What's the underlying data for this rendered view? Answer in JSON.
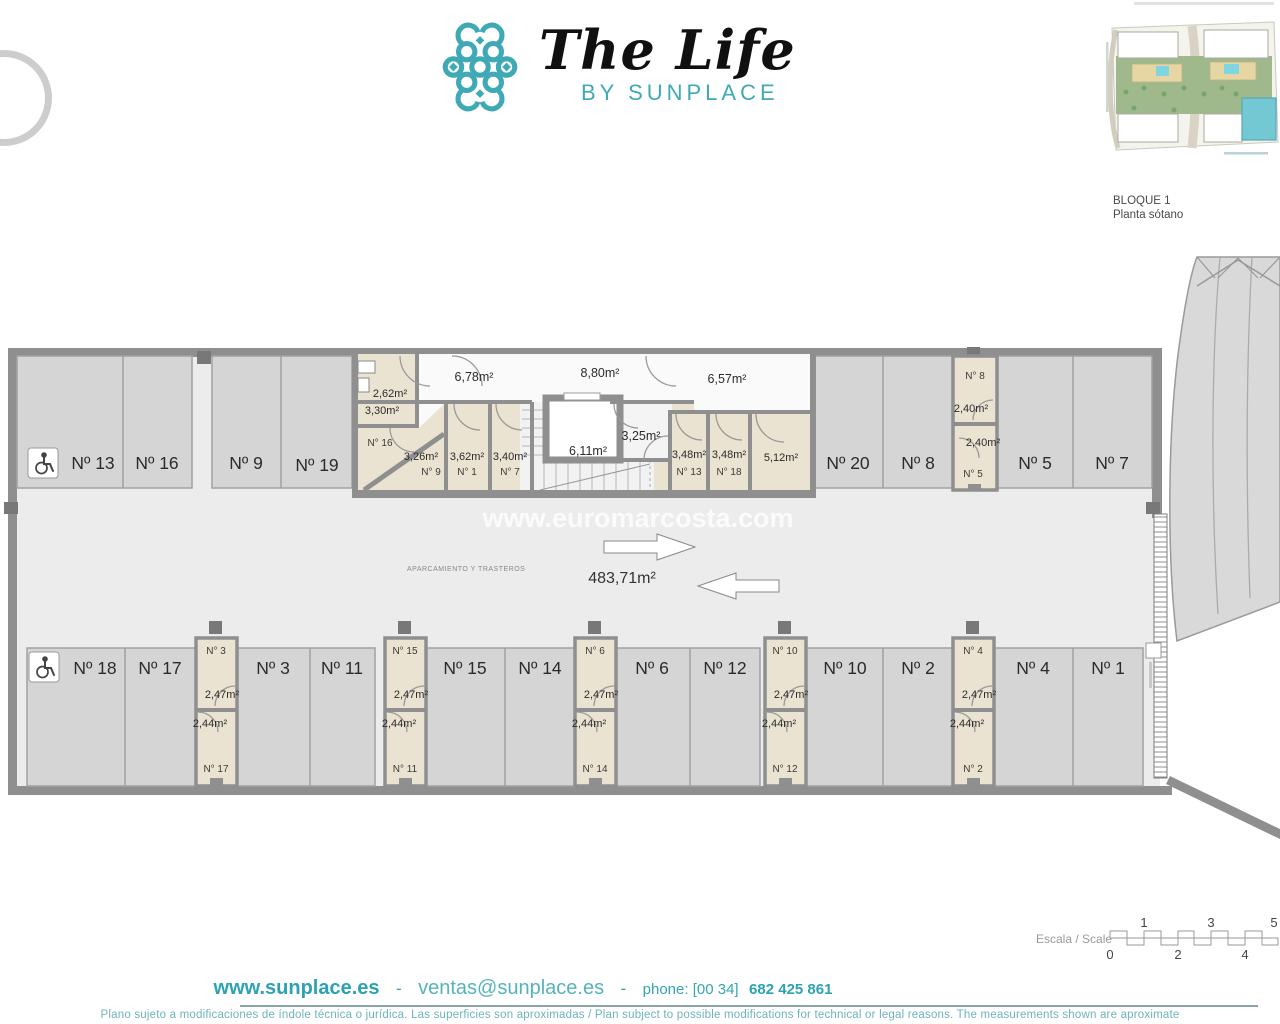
{
  "header": {
    "brand_title": "The Life",
    "brand_subtitle": "BY SUNPLACE",
    "block_label": "BLOQUE 1",
    "floor_label": "Planta sótano"
  },
  "plan": {
    "watermark": "www.euromarcosta.com",
    "total_area": "483,71m²",
    "zone_caption": "APARCAMIENTO Y TRASTEROS",
    "top_parking": {
      "p13": "Nº 13",
      "p16": "Nº 16",
      "p9": "Nº 9",
      "p19": "Nº 19",
      "p20": "Nº 20",
      "p8": "Nº 8",
      "p5": "Nº 5",
      "p7": "Nº 7"
    },
    "bottom_parking": {
      "p18": "Nº 18",
      "p17": "Nº 17",
      "p3": "Nº 3",
      "p11": "Nº 11",
      "p15": "Nº 15",
      "p14": "Nº 14",
      "p6": "Nº 6",
      "p12": "Nº 12",
      "p10": "Nº 10",
      "p2": "Nº 2",
      "p4": "Nº 4",
      "p1": "Nº 1"
    },
    "storage_top_col": {
      "top_label": "N° 8",
      "top_area": "2,40m²",
      "bottom_area": "2,40m²",
      "bottom_label": "N° 5"
    },
    "storage_cols": [
      {
        "top_label": "N° 3",
        "top_area": "2,47m²",
        "bottom_area": "2,44m²",
        "bottom_label": "N° 17"
      },
      {
        "top_label": "N° 15",
        "top_area": "2,47m²",
        "bottom_area": "2,44m²",
        "bottom_label": "N° 11"
      },
      {
        "top_label": "N° 6",
        "top_area": "2,47m²",
        "bottom_area": "2,44m²",
        "bottom_label": "N° 14"
      },
      {
        "top_label": "N° 10",
        "top_area": "2,47m²",
        "bottom_area": "2,44m²",
        "bottom_label": "N° 12"
      },
      {
        "top_label": "N° 4",
        "top_area": "2,47m²",
        "bottom_area": "2,44m²",
        "bottom_label": "N° 2"
      }
    ],
    "trastero_block": {
      "corridor1": "6,78m²",
      "corridor2": "8,80m²",
      "corridor3": "6,57m²",
      "room_a_area": "2,62m²",
      "room_b_area": "3,30m²",
      "room16_label": "N° 16",
      "room9_area": "3,26m²",
      "room9_label": "N° 9",
      "room1_area": "3,62m²",
      "room1_label": "N° 1",
      "room7_area": "3,40m²",
      "room7_label": "N° 7",
      "elevator_area": "6,11m²",
      "lobby_area": "3,25m²",
      "room13_area": "3,48m²",
      "room13_label": "N° 13",
      "room18_area": "3,48m²",
      "room18_label": "N° 18",
      "room512_area": "5,12m²"
    }
  },
  "scale_bar": {
    "label": "Escala / Scale",
    "ticks_top": [
      "1",
      "3",
      "5"
    ],
    "ticks_bottom": [
      "0",
      "2",
      "4"
    ]
  },
  "footer": {
    "website": "www.sunplace.es",
    "separator": "-",
    "email": "ventas@sunplace.es",
    "phone_label": "phone: [00 34]",
    "phone_number": "682 425 861",
    "disclaimer": "Plano sujeto a modificaciones de índole técnica o jurídica. Las superficies son aproximadas / Plan subject to possible modifications for technical or legal reasons. The measurements shown are aproximate"
  },
  "colors": {
    "teal": "#3FA9B6",
    "teal_light": "#55B3BE",
    "wall": "#8f8f8f",
    "stall": "#d5d5d5",
    "storage": "#ebe3d1"
  }
}
